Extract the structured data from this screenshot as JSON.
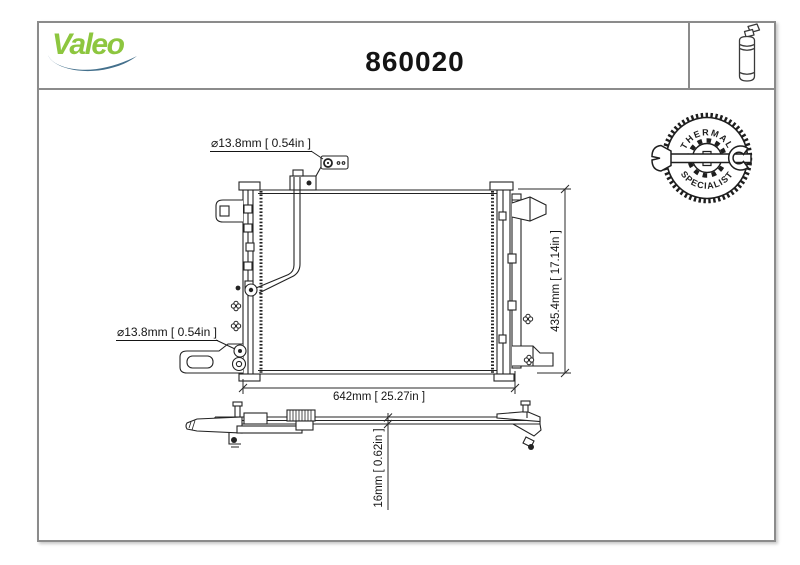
{
  "header": {
    "brand": "Valeo",
    "part_number": "860020"
  },
  "badge": {
    "top": "THERMAL",
    "bottom": "SPECIALIST"
  },
  "annotations": {
    "port_top": "⌀13.8mm [ 0.54in ]",
    "port_left": "⌀13.8mm [ 0.54in ]"
  },
  "dimensions": {
    "width": "642mm [ 25.27in ]",
    "height": "435.4mm [ 17.14in ]",
    "depth": "16mm [ 0.62in ]"
  },
  "icons": {
    "receiver_drier": "receiver-drier-icon",
    "wrench": "wrench-icon",
    "gear": "gear-icon",
    "valeo_swoosh": "valeo-swoosh-icon"
  },
  "colors": {
    "brand_green": "#8dc63f",
    "swoosh_blue": "#44708c",
    "line": "#232323",
    "frame": "#8b8b8b"
  }
}
